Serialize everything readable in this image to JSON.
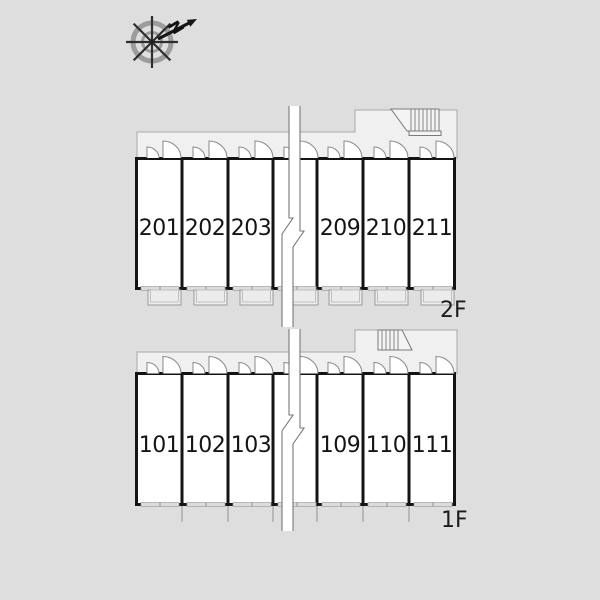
{
  "page": {
    "background_color": "#dedede"
  },
  "colors": {
    "wall": "#141414",
    "corridor_fill": "#f0f0f0",
    "unit_fill": "#ffffff",
    "background": "#dedede"
  },
  "compass": {
    "direction_label": "N"
  },
  "floors": [
    {
      "label": "2F",
      "unit_numbers": [
        "201",
        "202",
        "203",
        "209",
        "210",
        "211"
      ]
    },
    {
      "label": "1F",
      "unit_numbers": [
        "101",
        "102",
        "103",
        "109",
        "110",
        "111"
      ]
    }
  ]
}
